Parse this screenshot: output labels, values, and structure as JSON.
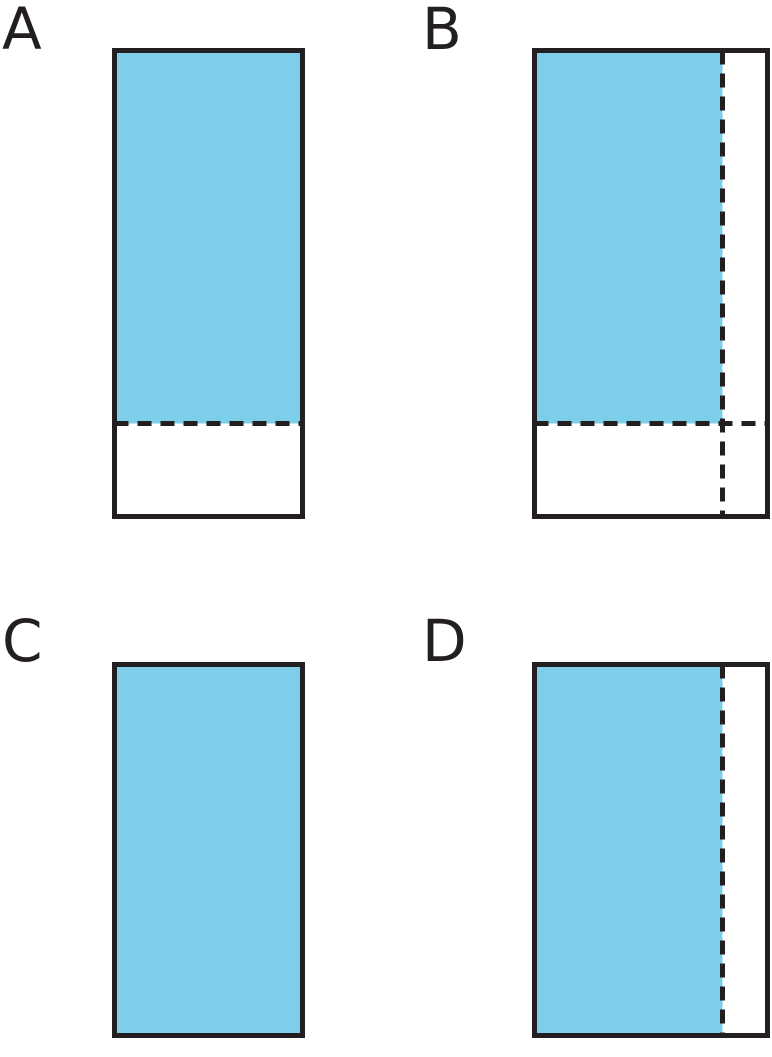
{
  "page": {
    "background": "#ffffff",
    "description": "Four rectangle fraction diagrams labeled A, B, C, D with shaded regions and dashed partition lines"
  },
  "colors": {
    "shade": "#7dcee8",
    "stroke": "#231f20",
    "label_text": "#231f20"
  },
  "figures": [
    {
      "label": "A",
      "shape": "tall rectangle",
      "shaded_region": "top portion shaded blue",
      "shaded_fraction_of_height": 0.8,
      "shaded_fraction_of_width": 1,
      "dashed_lines": [
        "horizontal dashed line at 4/5 of height"
      ]
    },
    {
      "label": "B",
      "shape": "tall rectangle",
      "shaded_region": "top-left portion shaded blue",
      "shaded_fraction_of_height": 0.8,
      "shaded_fraction_of_width": 0.8,
      "dashed_lines": [
        "vertical dashed line at 4/5 of width",
        "horizontal dashed line at 4/5 of height"
      ]
    },
    {
      "label": "C",
      "shape": "rectangle",
      "shaded_region": "entire rectangle shaded blue",
      "shaded_fraction_of_height": 1,
      "shaded_fraction_of_width": 1,
      "dashed_lines": []
    },
    {
      "label": "D",
      "shape": "rectangle",
      "shaded_region": "left portion shaded blue",
      "shaded_fraction_of_height": 1,
      "shaded_fraction_of_width": 0.8,
      "dashed_lines": [
        "vertical dashed line at 4/5 of width"
      ]
    }
  ]
}
